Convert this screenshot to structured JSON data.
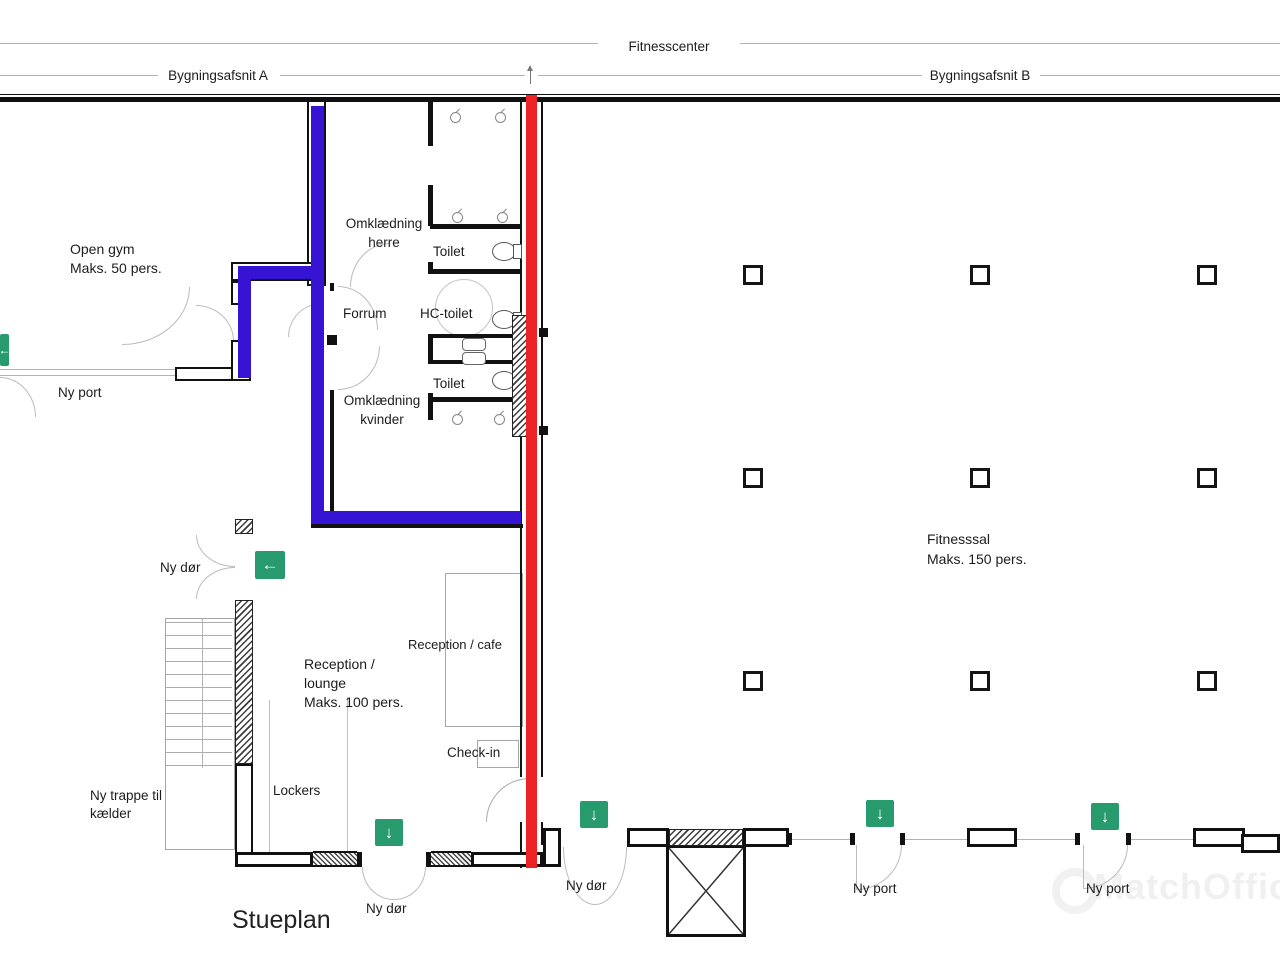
{
  "title": {
    "plan": "Stueplan"
  },
  "annotations": {
    "fitnesscenter": "Fitnesscenter",
    "section_a": "Bygningsafsnit A",
    "section_b": "Bygningsafsnit B"
  },
  "rooms": {
    "open_gym_name": "Open gym",
    "open_gym_cap": "Maks. 50 pers.",
    "omk_herre_1": "Omklædning",
    "omk_herre_2": "herre",
    "toilet_top": "Toilet",
    "forrum": "Forrum",
    "hc_toilet": "HC-toilet",
    "toilet_mid": "Toilet",
    "omk_kvinder_1": "Omklædning",
    "omk_kvinder_2": "kvinder",
    "fitnesssal_name": "Fitnesssal",
    "fitnesssal_cap": "Maks. 150 pers.",
    "reception_1": "Reception /",
    "reception_2": "lounge",
    "reception_3": "Maks. 100 pers.",
    "reception_cafe": "Reception / cafe",
    "check_in": "Check-in",
    "lockers": "Lockers",
    "trappe_1": "Ny trappe til",
    "trappe_2": "kælder"
  },
  "doors": {
    "ny_port_west": "Ny port",
    "ny_door_west": "Ny dør",
    "ny_door_south_1": "Ny dør",
    "ny_door_south_2": "Ny dør",
    "ny_port_south_1": "Ny port",
    "ny_port_south_2": "Ny port"
  },
  "icons": {
    "exit_down": "↓",
    "exit_left": "←"
  },
  "watermark": "MatchOffice",
  "colors": {
    "wall": "#111111",
    "route-blue": "#3714d4",
    "section-red": "#ec2224",
    "exit-green": "#279b6d",
    "thin-line": "#b3b3b3",
    "label": "#1c1c1c"
  }
}
